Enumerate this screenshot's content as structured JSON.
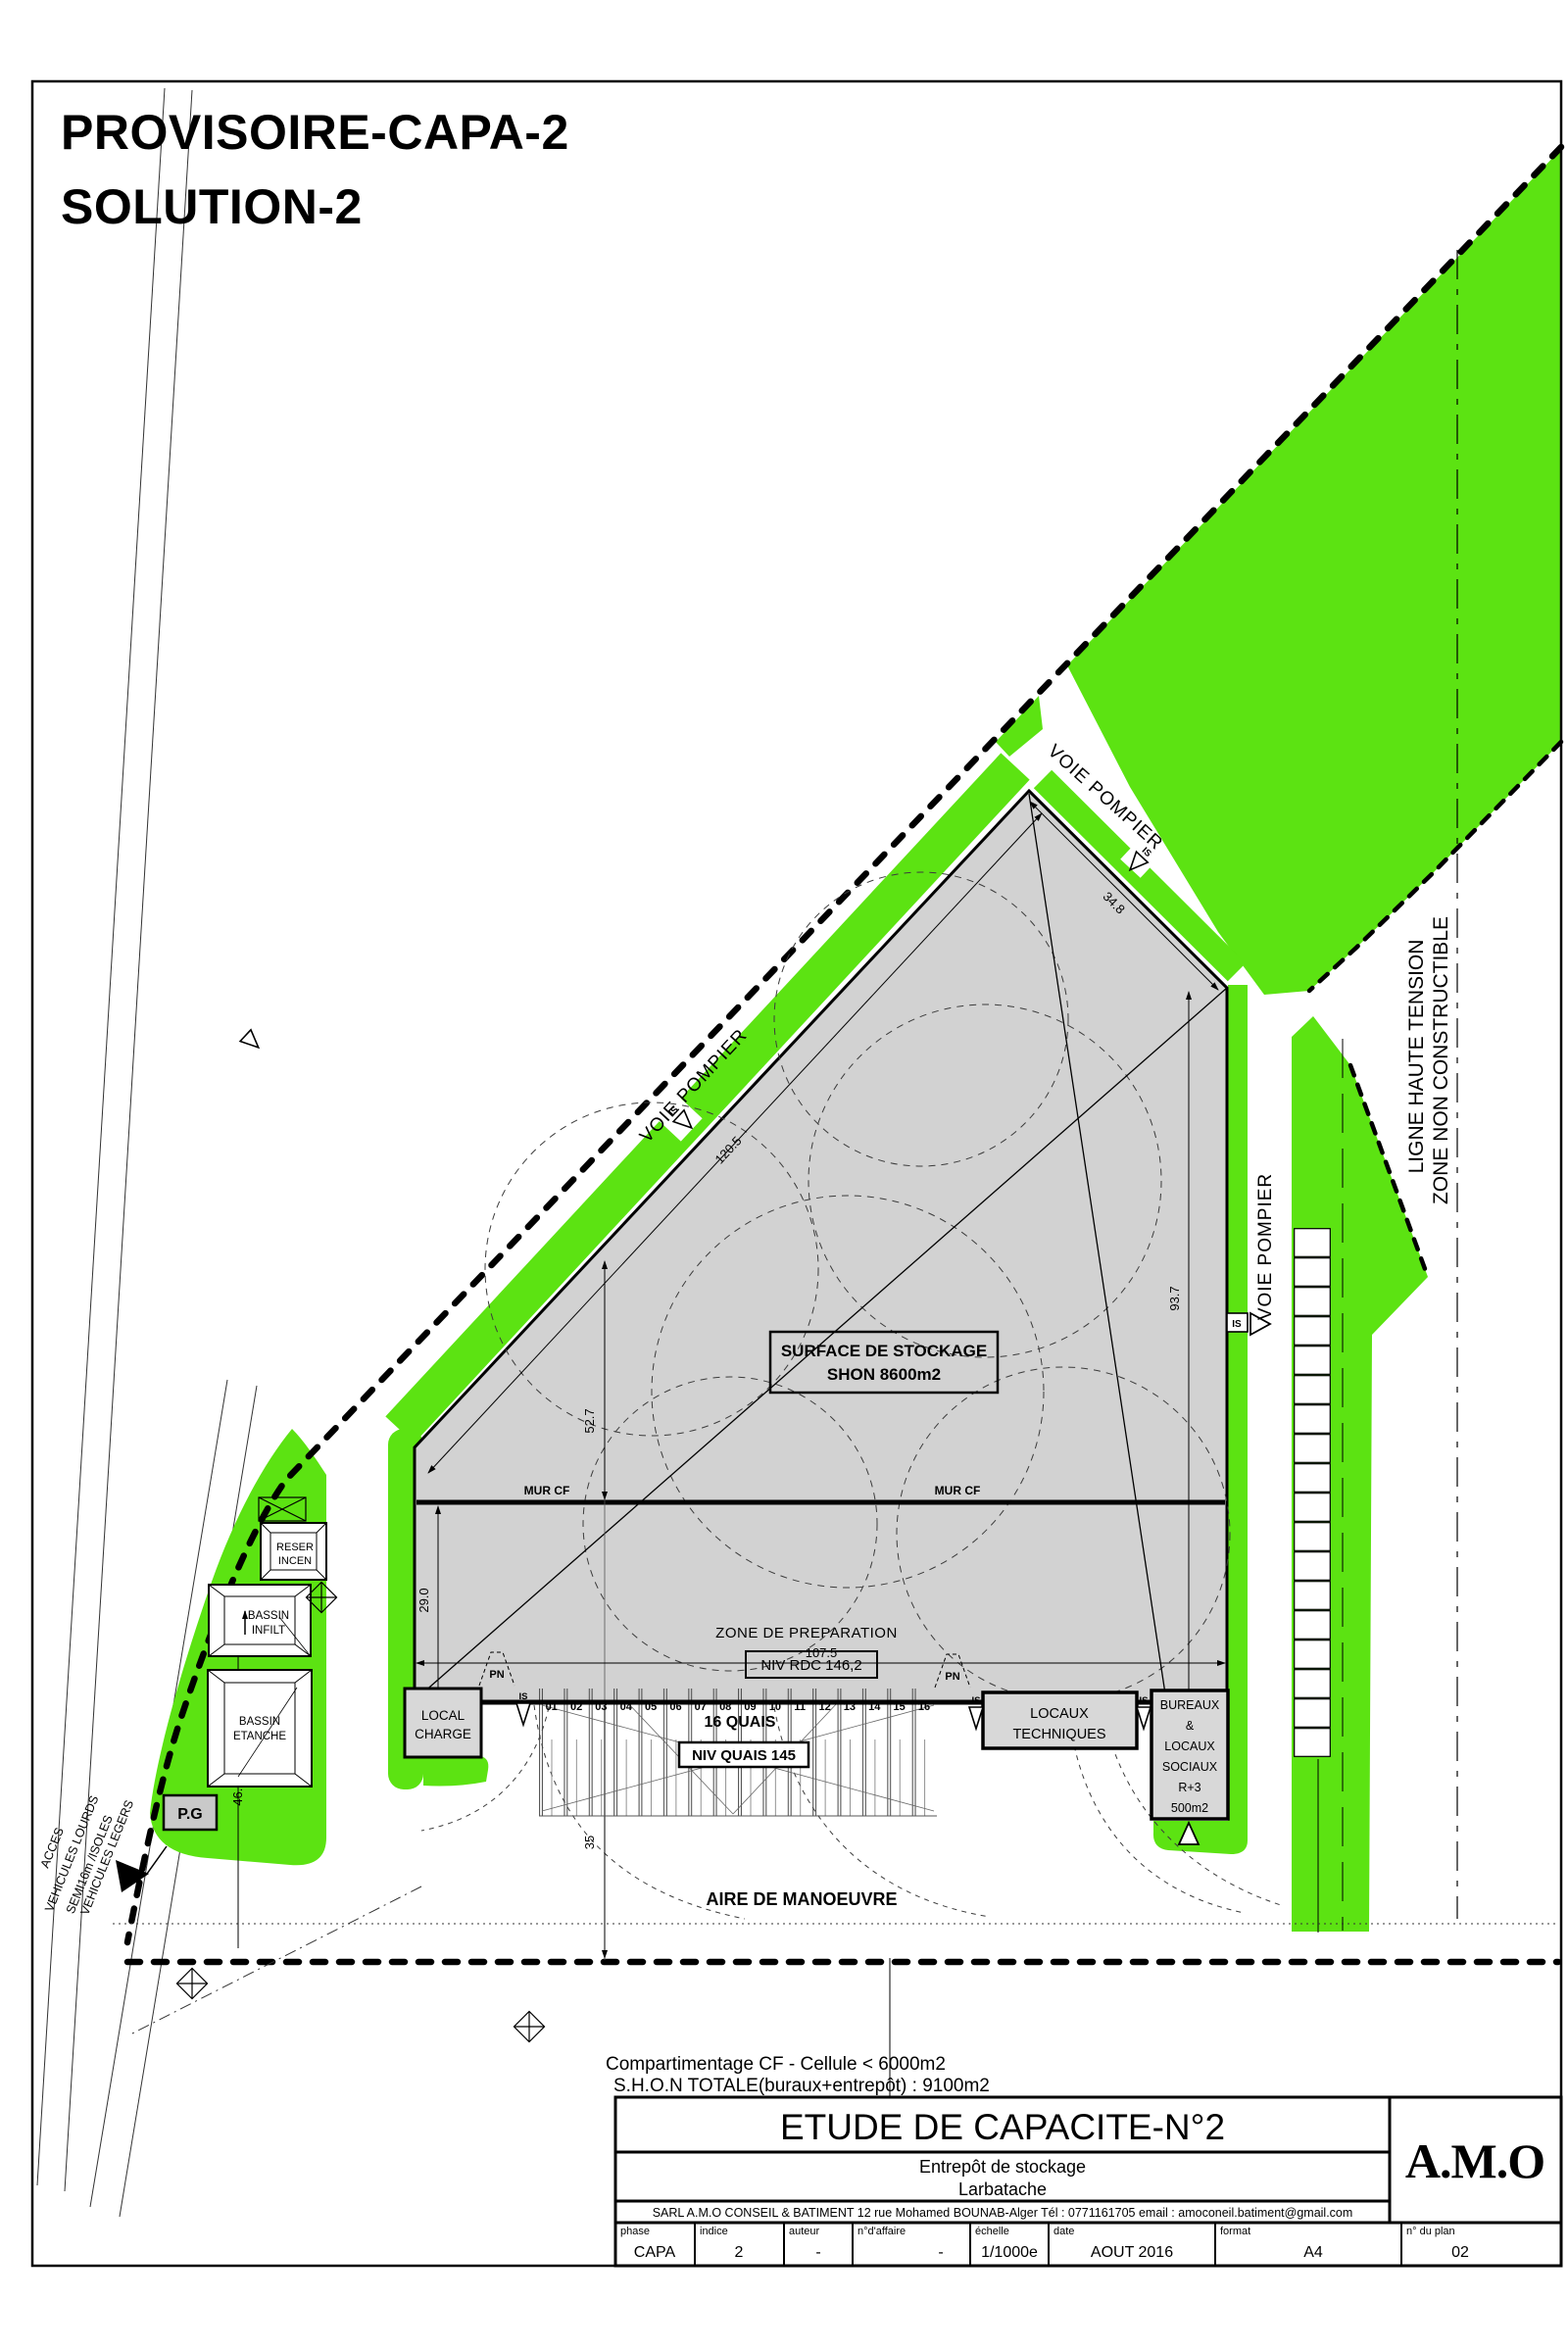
{
  "header": {
    "title_line1": "PROVISOIRE-CAPA-2",
    "title_line2": "SOLUTION-2"
  },
  "site": {
    "road_label": "VOIE POMPIER",
    "ht_line1": "LIGNE HAUTE TENSION",
    "ht_line2": "ZONE NON CONSTRUCTIBLE",
    "storage_line1": "SURFACE DE STOCKAGE",
    "storage_line2": "SHON 8600m2",
    "mur_cf": "MUR CF",
    "zone_preparation": "ZONE DE PREPARATION",
    "niv_rdc": "NIV RDC 146,2",
    "quais_title": "16 QUAIS",
    "niv_quais": "NIV QUAIS 145",
    "quai_numbers": [
      "01",
      "02",
      "03",
      "04",
      "05",
      "06",
      "07",
      "08",
      "09",
      "10",
      "11",
      "12",
      "13",
      "14",
      "15",
      "16"
    ],
    "local_charge": [
      "LOCAL",
      "CHARGE"
    ],
    "locaux_techniques": [
      "LOCAUX",
      "TECHNIQUES"
    ],
    "bureaux": [
      "BUREAUX",
      "&",
      "LOCAUX",
      "SOCIAUX",
      "R+3",
      "500m2"
    ],
    "reserve": [
      "RESER",
      "INCEN"
    ],
    "bassin_infilt": [
      "BASSIN",
      "INFILT"
    ],
    "bassin_etanche": [
      "BASSIN",
      "ETANCHE"
    ],
    "pg": "P.G",
    "aire": "AIRE DE MANOEUVRE",
    "acces": [
      "ACCES",
      "VEHICULES LOURDS",
      "SEMI16m /ISOLES",
      "VEHICULES LEGERS"
    ],
    "pn": "PN",
    "is": "IS",
    "dims": {
      "nw": "120.5",
      "ne": "34.8",
      "right": "93.7",
      "mid": "52.7",
      "left": "29.0",
      "width": "107.5",
      "bassin": "46.0",
      "apron": "35"
    }
  },
  "notes": {
    "line1": "Compartimentage CF - Cellule < 6000m2",
    "line2": "S.H.O.N TOTALE(buraux+entrepôt) : 9100m2"
  },
  "titleblock": {
    "title": "ETUDE DE CAPACITE-N°2",
    "project": "Entrepôt de stockage",
    "location": "Larbatache",
    "company": "SARL A.M.O CONSEIL & BATIMENT 12 rue Mohamed BOUNAB-Alger  Tél : 0771161705 email : amoconeil.batiment@gmail.com",
    "logo": "A.M.O",
    "table": [
      {
        "label": "phase",
        "value": "CAPA"
      },
      {
        "label": "indice",
        "value": "2"
      },
      {
        "label": "auteur",
        "value": "-"
      },
      {
        "label": "n°d'affaire",
        "value": "-"
      },
      {
        "label": "échelle",
        "value": "1/1000e"
      },
      {
        "label": "date",
        "value": "AOUT 2016"
      },
      {
        "label": "format",
        "value": "A4"
      },
      {
        "label": "n° du plan",
        "value": "02"
      }
    ]
  },
  "colors": {
    "green": "#5ce312",
    "building": "#d2d2d2",
    "box": "#d8d8d8"
  }
}
